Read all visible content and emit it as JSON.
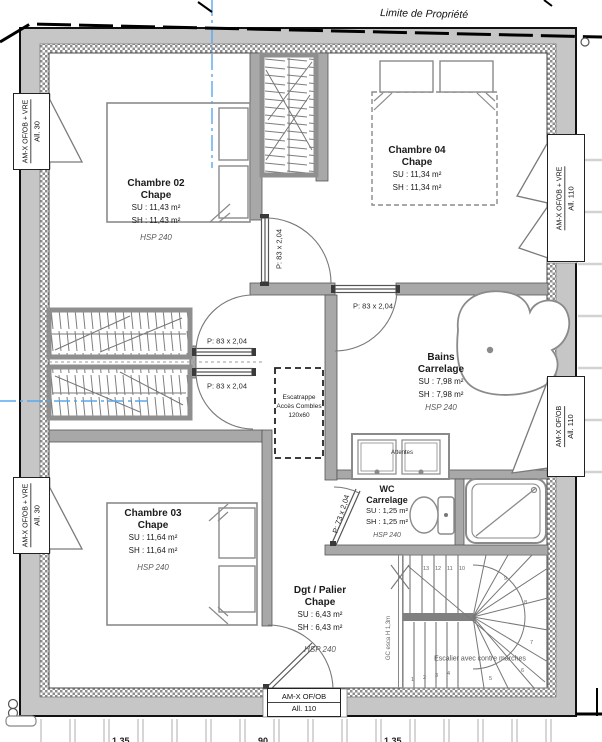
{
  "plan": {
    "property_line_label": "Limite de Propriété",
    "rooms": {
      "chambre02": {
        "name": "Chambre 02",
        "finish": "Chape",
        "su": "SU : 11,43 m²",
        "sh": "SH : 11,43 m²",
        "hsp": "HSP 240"
      },
      "chambre04": {
        "name": "Chambre 04",
        "finish": "Chape",
        "su": "SU : 11,34 m²",
        "sh": "SH : 11,34 m²"
      },
      "chambre03": {
        "name": "Chambre 03",
        "finish": "Chape",
        "su": "SU : 11,64 m²",
        "sh": "SH : 11,64 m²",
        "hsp": "HSP 240"
      },
      "bains": {
        "name": "Bains",
        "finish": "Carrelage",
        "su": "SU : 7,98 m²",
        "sh": "SH : 7,98 m²",
        "hsp": "HSP 240"
      },
      "wc": {
        "name": "WC",
        "finish": "Carrelage",
        "su": "SU : 1,25 m²",
        "sh": "SH : 1,25 m²",
        "hsp": "HSP 240"
      },
      "palier": {
        "name": "Dgt / Palier",
        "finish": "Chape",
        "su": "SU : 6,43 m²",
        "sh": "SH : 6,43 m²",
        "hsp": "HSP 240"
      }
    },
    "doors": {
      "d83": "P: 83 x 2,04",
      "d73": "P: 73 x 2,04"
    },
    "windows": {
      "left_top": {
        "line1": "AM-X OF/OB + VRE",
        "line2": "All. 30"
      },
      "left_bottom": {
        "line1": "AM-X OF/OB + VRE",
        "line2": "All. 30"
      },
      "right_top": {
        "line1": "AM-X OF/OB + VRE",
        "line2": "All. 110"
      },
      "right_mid": {
        "line1": "AM-X OF/OB",
        "line2": "All. 110"
      },
      "bottom": {
        "line1": "AM-X OF/OB",
        "line2": "All. 110"
      }
    },
    "attic_hatch": {
      "line1": "Escatrappe",
      "line2": "Accès Combles",
      "line3": "120x60"
    },
    "vanity_label": "Attentes",
    "stairs": {
      "label": "Escalier avec contre marches",
      "guardrail": "GC esca H 1,3m",
      "treads": [
        "1",
        "2",
        "3",
        "4",
        "5",
        "6",
        "7",
        "8",
        "9",
        "10",
        "11",
        "12",
        "13"
      ]
    },
    "partial_dims": [
      "1.35",
      "90",
      "1.35"
    ],
    "colors": {
      "axis_blue": "#57a8f0",
      "wall_gray": "#c6c6c6",
      "drawing_gray": "#8a8a8a",
      "property_black": "#000000"
    }
  }
}
